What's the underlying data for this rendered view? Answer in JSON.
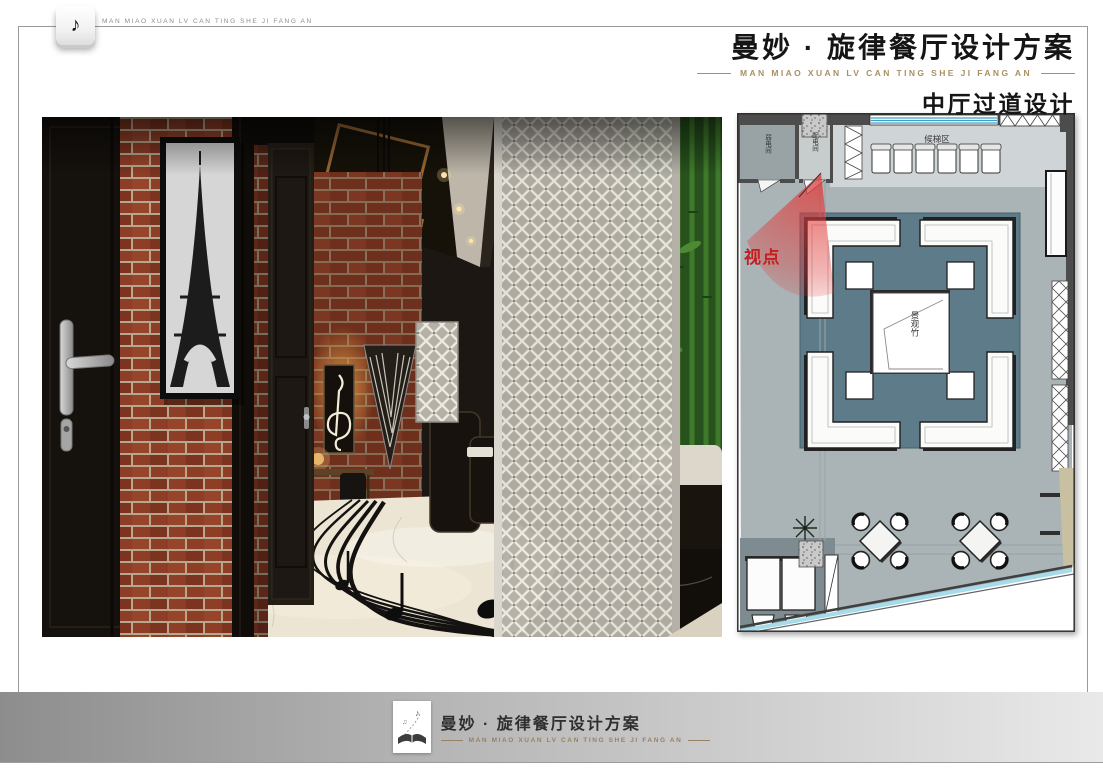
{
  "header": {
    "note_glyph": "♪",
    "brand_caption": "MAN MIAO XUAN LV CAN TING SHE JI FANG AN",
    "title_cn": "曼妙 · 旋律餐厅设计方案",
    "title_en": "MAN MIAO XUAN LV CAN TING SHE JI FANG AN",
    "subtitle": "中厅过道设计"
  },
  "plan": {
    "labels": {
      "viewpoint": "视点",
      "utility_room": "弱电间",
      "power_room": "配电间",
      "waiting_area": "候梯区",
      "bamboo_feature": "景观竹"
    },
    "colors": {
      "floor": "#aab3b5",
      "waiting_floor": "#cfd4d6",
      "carpet": "#5e7b8a",
      "wall": "#4c4c4c",
      "glass": "#a5dbeb",
      "viewpoint_red": "#c21f1f",
      "tan_strip": "#c9c0a2"
    }
  },
  "footer": {
    "title_cn": "曼妙 · 旋律餐厅设计方案",
    "title_en": "MAN MIAO XUAN LV CAN TING SHE JI FANG AN",
    "note_glyph_1": "♪",
    "note_glyph_2": "♫"
  }
}
